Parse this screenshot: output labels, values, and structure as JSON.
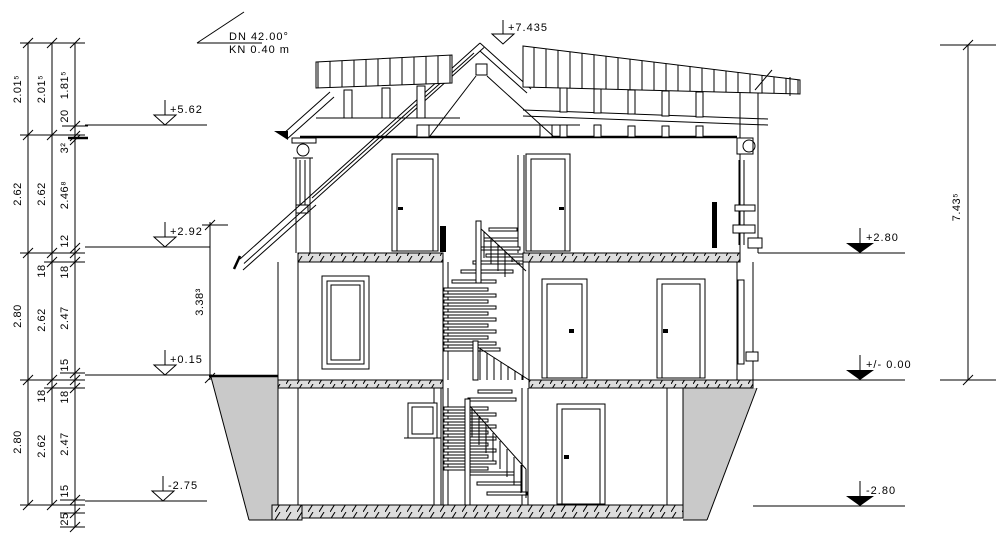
{
  "drawing": {
    "title_note": {
      "pitch": "DN 42.00°",
      "eave": "KN 0.40 m"
    },
    "levels": {
      "ridge": "+7.435",
      "left": [
        "+5.62",
        "+2.92",
        "+0.15",
        "-2.75"
      ],
      "right": [
        "+2.80",
        "+/- 0.00",
        "-2.80"
      ]
    },
    "dims": {
      "chain_outer": [
        "2.01⁵",
        "2.62",
        "2.80",
        "2.80"
      ],
      "chain_middle": [
        "2.01⁵",
        "2.62",
        "18",
        "2.62",
        "18",
        "2.62"
      ],
      "chain_inner": [
        "1.81⁵",
        "20",
        "3²",
        "2.46⁸",
        "12",
        "18",
        "2.47",
        "15",
        "18",
        "2.47",
        "15",
        "25"
      ],
      "porch_height": "3.38³",
      "overall_height": "7.43⁵"
    },
    "colors": {
      "line": "#000000",
      "slab_fill": "#dddddd",
      "slab_hatch": "#a3506e",
      "earth_fill": "#c9c9c9",
      "background": "#ffffff"
    }
  }
}
